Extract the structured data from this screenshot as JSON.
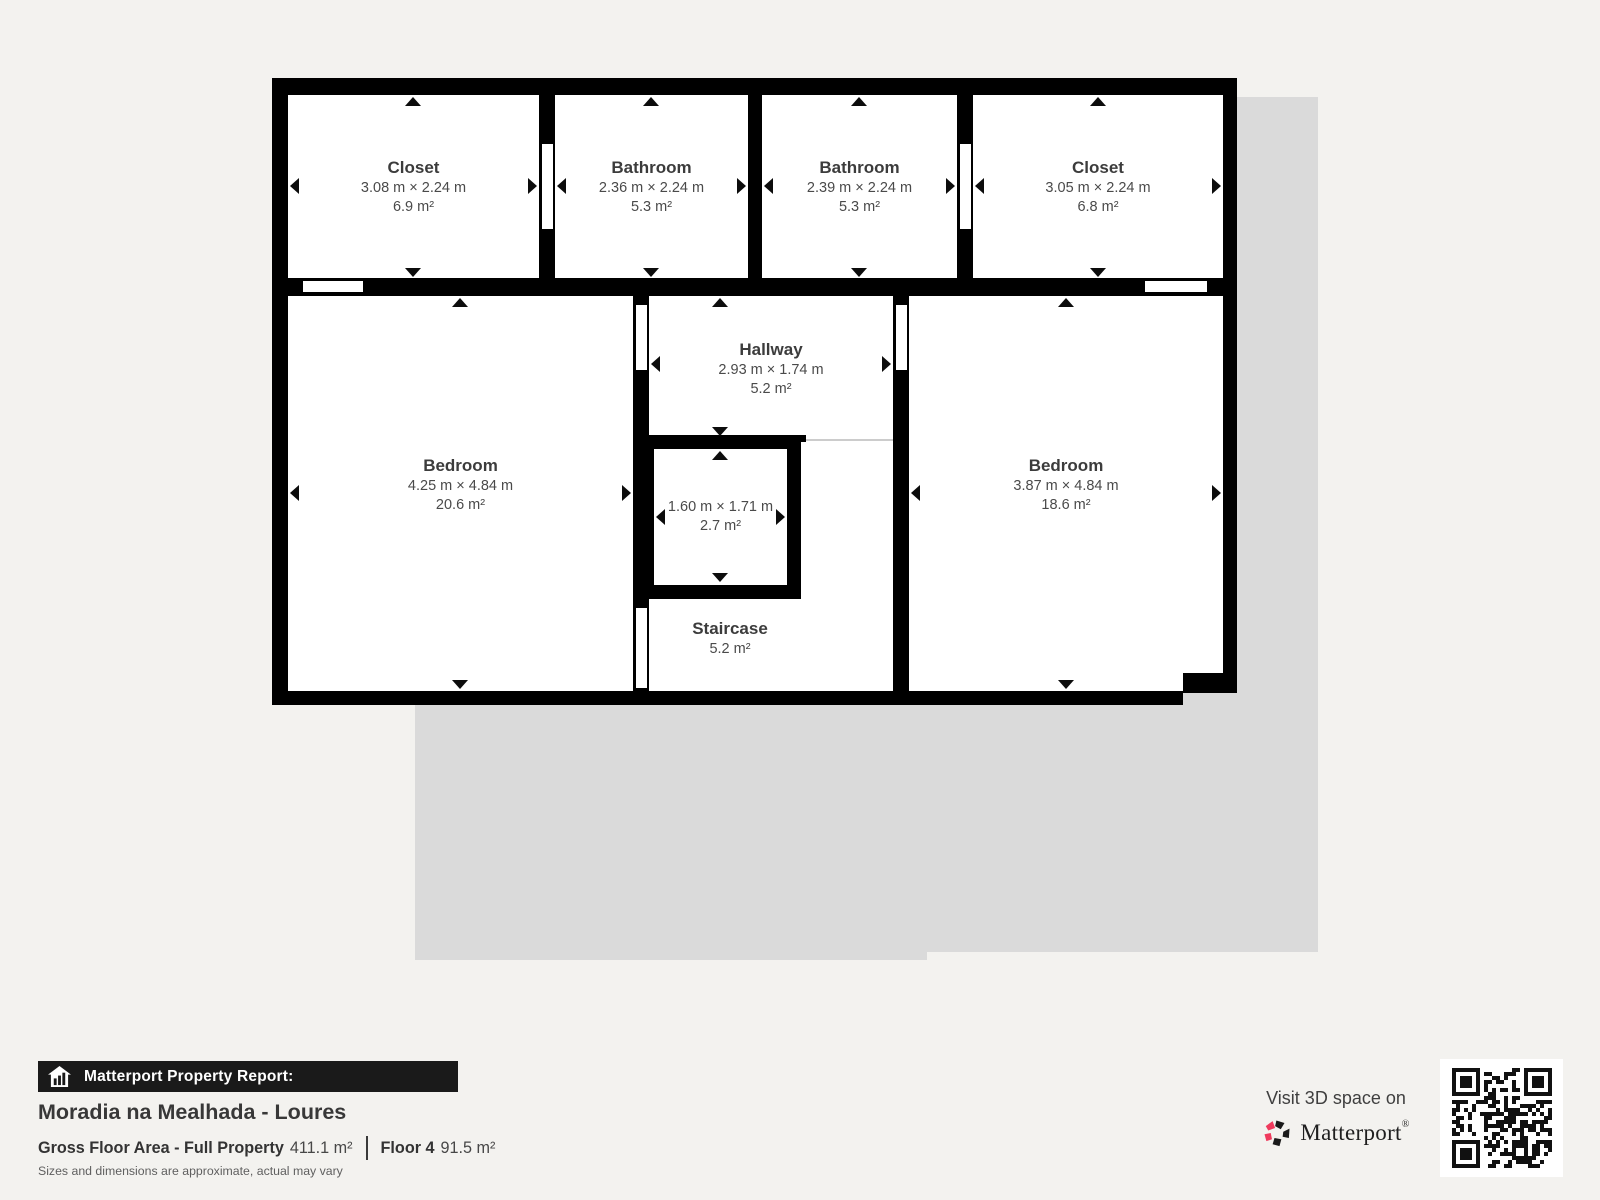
{
  "plan": {
    "rooms": {
      "closet1": {
        "name": "Closet",
        "dims": "3.08 m × 2.24 m",
        "area": "6.9 m²"
      },
      "bathroom1": {
        "name": "Bathroom",
        "dims": "2.36 m × 2.24 m",
        "area": "5.3 m²"
      },
      "bathroom2": {
        "name": "Bathroom",
        "dims": "2.39 m × 2.24 m",
        "area": "5.3 m²"
      },
      "closet2": {
        "name": "Closet",
        "dims": "3.05 m × 2.24 m",
        "area": "6.8 m²"
      },
      "bedroom_left": {
        "name": "Bedroom",
        "dims": "4.25 m × 4.84 m",
        "area": "20.6 m²"
      },
      "hallway": {
        "name": "Hallway",
        "dims": "2.93 m × 1.74 m",
        "area": "5.2 m²"
      },
      "small_room": {
        "dims": "1.60 m × 1.71 m",
        "area": "2.7 m²"
      },
      "bedroom_right": {
        "name": "Bedroom",
        "dims": "3.87 m × 4.84 m",
        "area": "18.6 m²"
      },
      "staircase": {
        "name": "Staircase",
        "area": "5.2 m²"
      }
    }
  },
  "report": {
    "banner": "Matterport Property Report:",
    "property_name": "Moradia na Mealhada - Loures",
    "gfa_label": "Gross Floor Area - Full Property",
    "gfa_value": "411.1 m²",
    "floor_label": "Floor 4",
    "floor_value": "91.5 m²",
    "disclaimer": "Sizes and dimensions are approximate, actual may vary"
  },
  "promo": {
    "visit_text": "Visit 3D space on",
    "brand": "Matterport",
    "trademark": "®"
  },
  "colors": {
    "wall": "#000000",
    "floor": "#ffffff",
    "silhouette": "#dadada",
    "background": "#f3f2ef",
    "accent_pink": "#ef3a5d"
  }
}
